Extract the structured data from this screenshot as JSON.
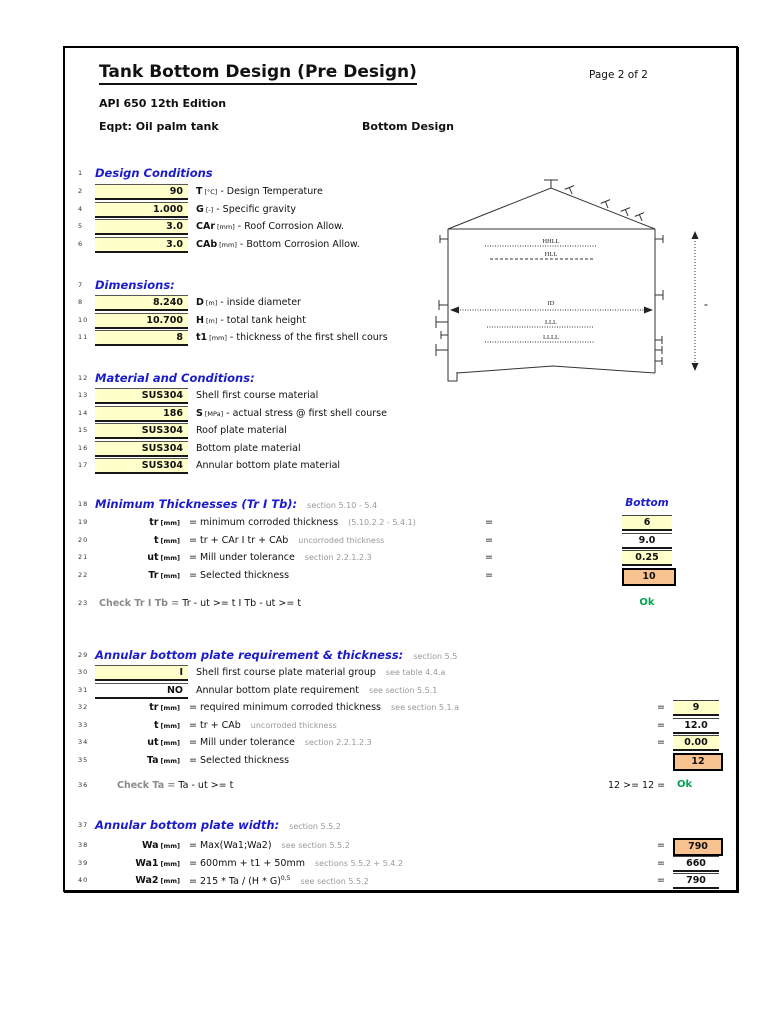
{
  "page": {
    "title": "Tank Bottom Design (Pre Design)",
    "page_label": "Page 2 of 2",
    "standard": "API 650 12th Edition",
    "equipment": "Eqpt: Oil palm tank",
    "subtitle": "Bottom Design"
  },
  "colors": {
    "accent_blue": "#1c1ccc",
    "ok_green": "#00a651",
    "cell_yellow": "#ffffc9",
    "cell_orange": "#f9c291",
    "note_gray": "#999999"
  },
  "design_conditions": {
    "line": "1",
    "heading": "Design Conditions",
    "rows": [
      {
        "line": "2",
        "value": "90",
        "var": "T",
        "unit": "[°C]",
        "desc": "- Design Temperature"
      },
      {
        "line": "4",
        "value": "1.000",
        "var": "G",
        "unit": "[-]",
        "desc": "- Specific gravity"
      },
      {
        "line": "5",
        "value": "3.0",
        "var": "CAr",
        "unit": "[mm]",
        "desc": "- Roof Corrosion Allow."
      },
      {
        "line": "6",
        "value": "3.0",
        "var": "CAb",
        "unit": "[mm]",
        "desc": "- Bottom Corrosion Allow."
      }
    ]
  },
  "dimensions": {
    "line": "7",
    "heading": "Dimensions:",
    "rows": [
      {
        "line": "8",
        "value": "8.240",
        "var": "D",
        "unit": "[m]",
        "desc": "- inside diameter"
      },
      {
        "line": "10",
        "value": "10.700",
        "var": "H",
        "unit": "[m]",
        "desc": "- total tank height"
      },
      {
        "line": "11",
        "value": "8",
        "var": "t1",
        "unit": "[mm]",
        "desc": "- thickness of the first shell cours"
      }
    ]
  },
  "materials": {
    "line": "12",
    "heading": "Material and Conditions:",
    "rows": [
      {
        "line": "13",
        "value": "SUS304",
        "var": "",
        "unit": "",
        "desc": "Shell first course material"
      },
      {
        "line": "14",
        "value": "186",
        "var": "S",
        "unit": "[MPa]",
        "desc": "- actual stress @ first shell course"
      },
      {
        "line": "15",
        "value": "SUS304",
        "var": "",
        "unit": "",
        "desc": "Roof plate material"
      },
      {
        "line": "16",
        "value": "SUS304",
        "var": "",
        "unit": "",
        "desc": "Bottom plate material"
      },
      {
        "line": "17",
        "value": "SUS304",
        "var": "",
        "unit": "",
        "desc": "Annular bottom plate material"
      }
    ]
  },
  "min_thickness": {
    "line": "18",
    "heading": "Minimum Thicknesses (Tr I Tb):",
    "note": "section 5.10 - 5.4",
    "col_header": "Bottom",
    "rows": [
      {
        "line": "19",
        "var": "tr",
        "unit": "[mm]",
        "eq": "= minimum corroded thickness",
        "note": "(5.10.2.2 - 5.4.1)",
        "sign": "=",
        "value": "6",
        "cell": "yellow"
      },
      {
        "line": "20",
        "var": "t",
        "unit": "[mm]",
        "eq": "= tr + CAr  I  tr + CAb",
        "note": "uncorroded thickness",
        "sign": "=",
        "value": "9.0",
        "cell": "white"
      },
      {
        "line": "21",
        "var": "ut",
        "unit": "[mm]",
        "eq": "= Mill under tolerance",
        "note": "section 2.2.1.2.3",
        "sign": "=",
        "value": "0.25",
        "cell": "yellow"
      },
      {
        "line": "22",
        "var": "Tr",
        "unit": "[mm]",
        "eq": "= Selected thickness",
        "note": "",
        "sign": "=",
        "value": "10",
        "cell": "orange"
      }
    ],
    "check": {
      "line": "23",
      "label": "Check Tr I Tb =",
      "formula": "Tr - ut >= t   I   Tb - ut >= t",
      "result": "Ok"
    }
  },
  "annular_req": {
    "line": "29",
    "heading": "Annular bottom plate requirement & thickness:",
    "note": "section 5.5",
    "rows_input": [
      {
        "line": "30",
        "value": "I",
        "cell": "yellow",
        "desc": "Shell first course plate material group",
        "note": "see table 4.4.a"
      },
      {
        "line": "31",
        "value": "NO",
        "cell": "white",
        "desc": "Annular bottom plate requirement",
        "note": "see section 5.5.1"
      }
    ],
    "rows_calc": [
      {
        "line": "32",
        "var": "tr",
        "unit": "[mm]",
        "eq": "= required minimum corroded thickness",
        "note": "see section 5.1.a",
        "sign": "=",
        "value": "9",
        "cell": "yellow"
      },
      {
        "line": "33",
        "var": "t",
        "unit": "[mm]",
        "eq": "= tr + CAb",
        "note": "uncorroded thickness",
        "sign": "=",
        "value": "12.0",
        "cell": "white"
      },
      {
        "line": "34",
        "var": "ut",
        "unit": "[mm]",
        "eq": "= Mill under tolerance",
        "note": "section 2.2.1.2.3",
        "sign": "=",
        "value": "0.00",
        "cell": "yellow"
      },
      {
        "line": "35",
        "var": "Ta",
        "unit": "[mm]",
        "eq": "= Selected thickness",
        "note": "",
        "sign": "",
        "value": "12",
        "cell": "orange"
      }
    ],
    "check": {
      "line": "36",
      "label": "Check Ta =",
      "formula": "Ta - ut >= t",
      "comparison": "12 >= 12 =",
      "result": "Ok"
    }
  },
  "annular_width": {
    "line": "37",
    "heading": "Annular bottom plate width:",
    "note": "section 5.5.2",
    "rows": [
      {
        "line": "38",
        "var": "Wa",
        "unit": "[mm]",
        "eq": "= Max(Wa1;Wa2)",
        "sup": "",
        "note": "see section 5.5.2",
        "sign": "=",
        "value": "790",
        "cell": "orange"
      },
      {
        "line": "39",
        "var": "Wa1",
        "unit": "[mm]",
        "eq": "= 600mm + t1 + 50mm",
        "sup": "",
        "note": "sections 5.5.2 + 5.4.2",
        "sign": "=",
        "value": "660",
        "cell": "white"
      },
      {
        "line": "40",
        "var": "Wa2",
        "unit": "[mm]",
        "eq": "= 215 * Ta / (H * G)",
        "sup": "0,5",
        "note": "see section 5.5.2",
        "sign": "=",
        "value": "790",
        "cell": "white"
      }
    ]
  },
  "diagram": {
    "labels": {
      "hhll": "HHLL",
      "hll": "HLL",
      "id": "ID",
      "lll": "LLL",
      "llll": "LLLL",
      "height_mark": "="
    }
  }
}
